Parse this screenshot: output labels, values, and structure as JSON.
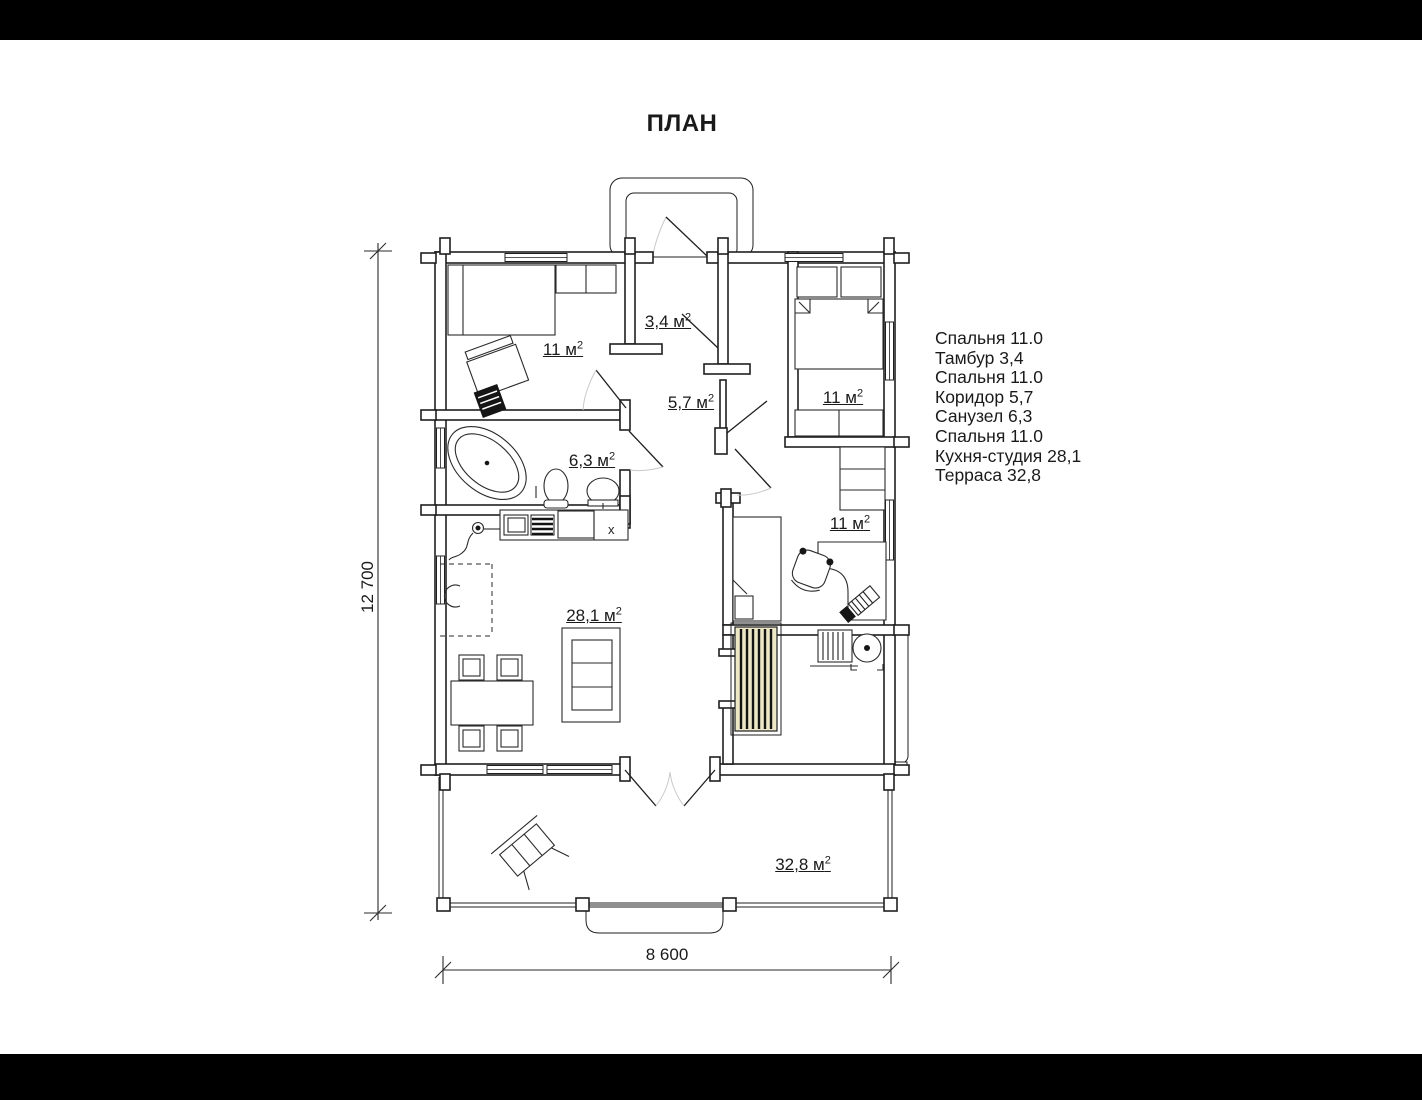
{
  "page": {
    "title": "ПЛАН"
  },
  "legend": {
    "items": [
      "Спальня 11.0",
      "Тамбур 3,4",
      "Спальня 11.0",
      "Коридор 5,7",
      "Санузел 6,3",
      "Спальня 11.0",
      "Кухня-студия 28,1",
      "Терраса 32,8"
    ]
  },
  "rooms": [
    {
      "id": "bedroom-top-left",
      "area": "11 м",
      "sup": "2"
    },
    {
      "id": "vestibule",
      "area": "3,4 м",
      "sup": "2"
    },
    {
      "id": "bedroom-top-right",
      "area": "11 м",
      "sup": "2"
    },
    {
      "id": "corridor",
      "area": "5,7 м",
      "sup": "2"
    },
    {
      "id": "bathroom",
      "area": "6,3 м",
      "sup": "2"
    },
    {
      "id": "bedroom-middle-right",
      "area": "11 м",
      "sup": "2"
    },
    {
      "id": "kitchen-studio",
      "area": "28,1 м",
      "sup": "2"
    },
    {
      "id": "terrace",
      "area": "32,8 м",
      "sup": "2"
    }
  ],
  "dimensions": {
    "height_label": "12 700",
    "width_label": "8 600"
  },
  "plan": {
    "x_mark": "x"
  },
  "colors": {
    "line": "#1f1f1f",
    "stair_fill": "#ece7c5",
    "background": "#ffffff",
    "letterbox": "#000000"
  }
}
